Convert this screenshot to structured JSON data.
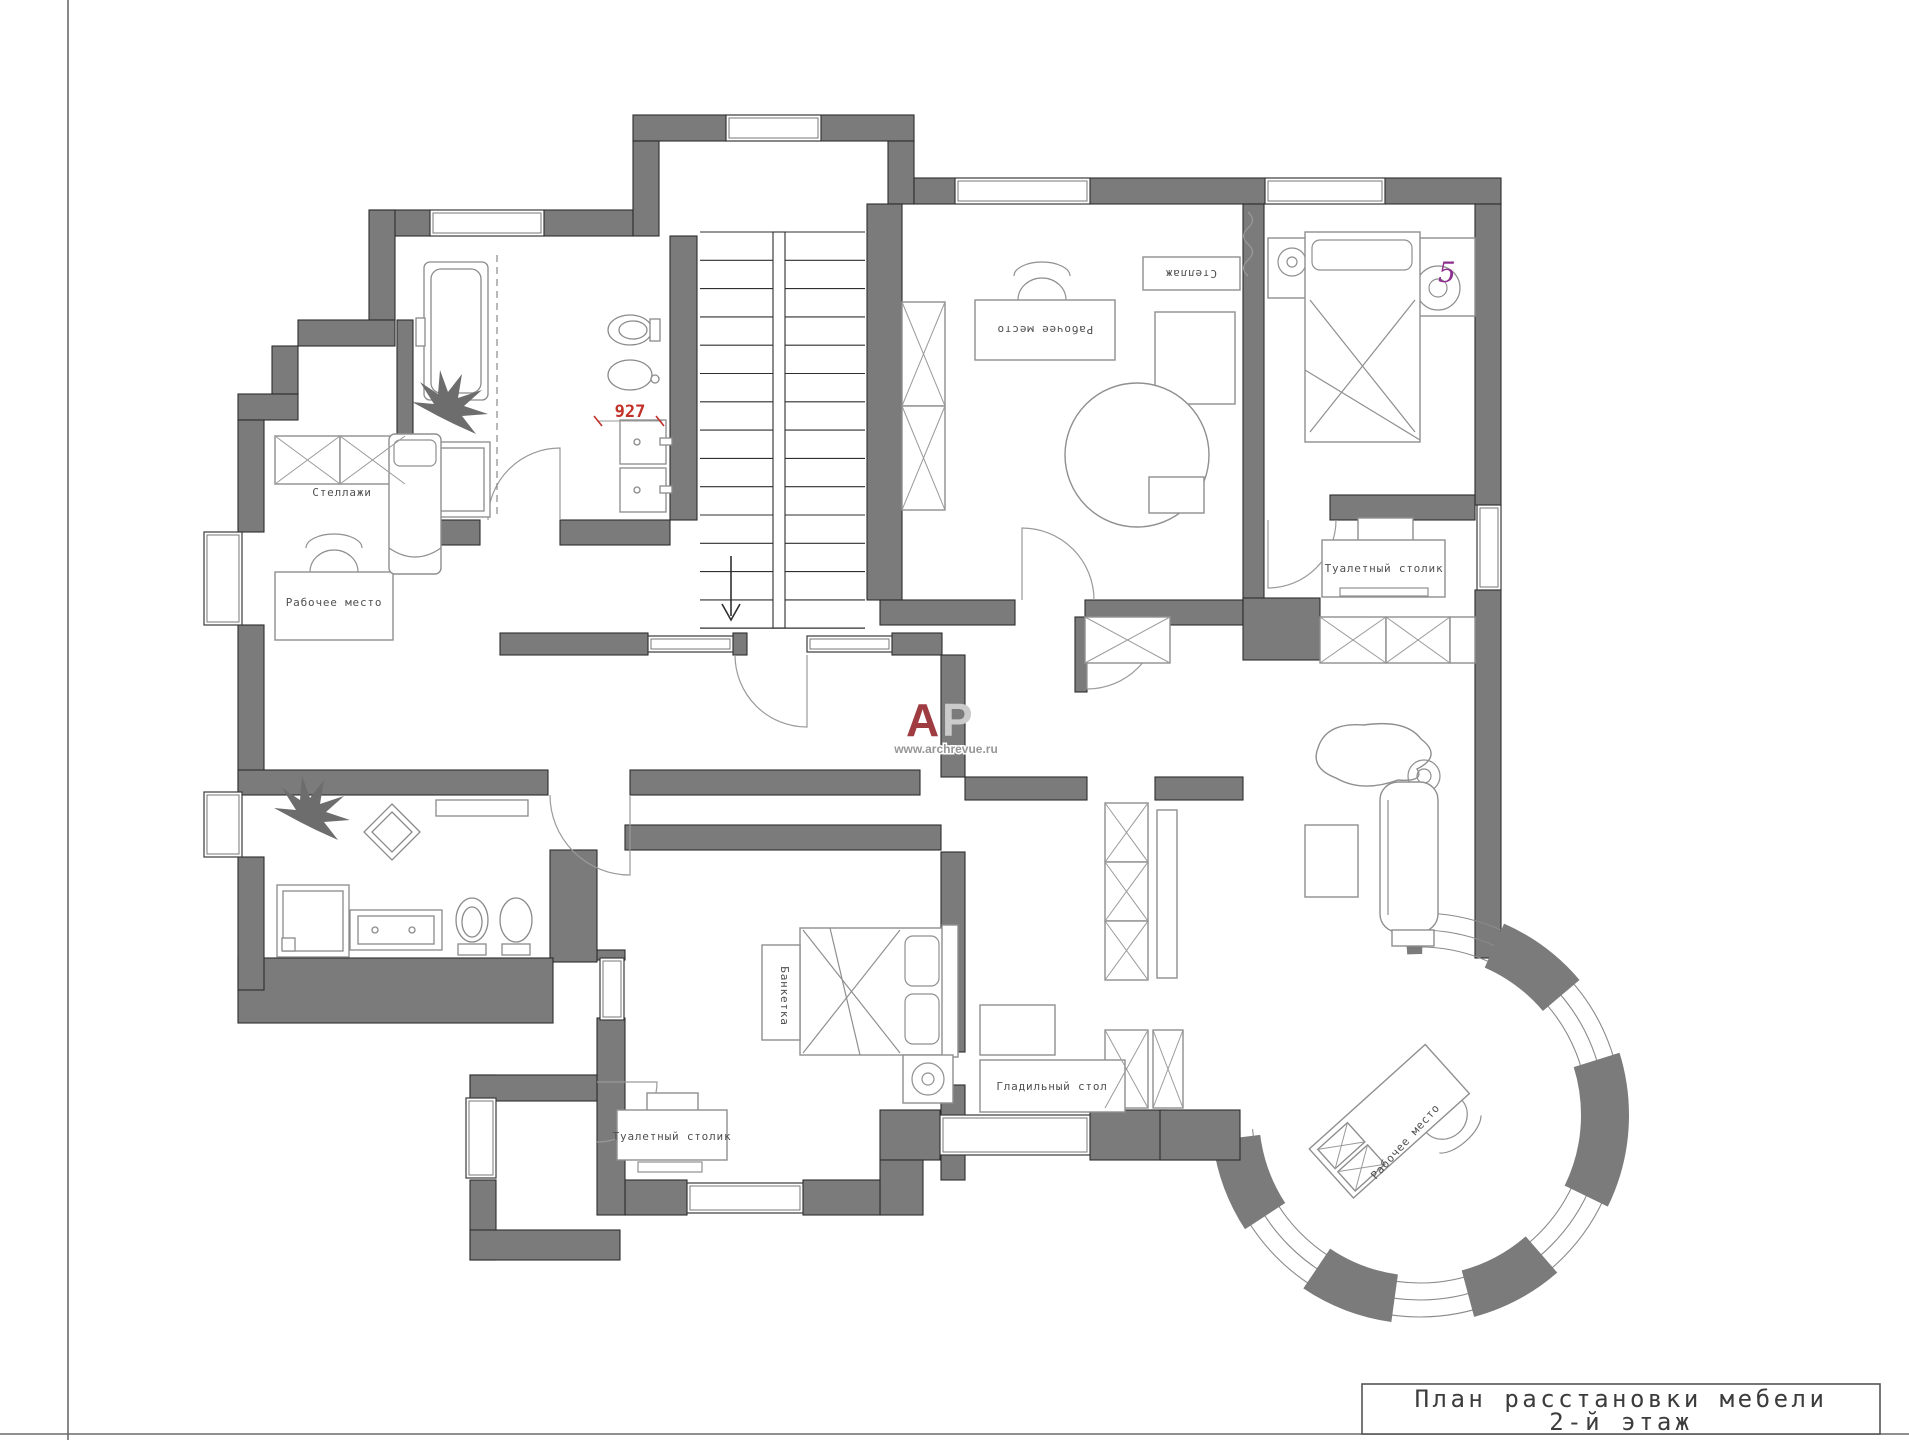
{
  "title_block": {
    "line1": "План расстановки мебели",
    "line2": "2-й этаж"
  },
  "logo": {
    "letter_a": "А",
    "letter_p": "Р",
    "url": "www.archrevue.ru"
  },
  "labels": {
    "shelves": "Стеллажи",
    "workplace_left": "Рабочее место",
    "workplace_top": "Рабочее место",
    "shelf": "Стеллаж",
    "dressing_table_right": "Туалетный столик",
    "dressing_table_bottom": "Туалетный столик",
    "ironing_table": "Гладильный стол",
    "banquette": "Банкетка",
    "workplace_turret": "Рабочее место"
  },
  "annotations": {
    "dimension": "927",
    "room_number": "5"
  },
  "colors": {
    "wall": "#7b7b7b",
    "outline": "#2d2d2d",
    "furniture": "#8f8f8f",
    "glass": "#9a9a9a",
    "dim_red": "#c23128",
    "marker": "#8e2e8e",
    "logo_red": "#9e3c42",
    "logo_gray": "#cbcbcb",
    "label": "#4f4f4f",
    "frame": "#555555"
  }
}
